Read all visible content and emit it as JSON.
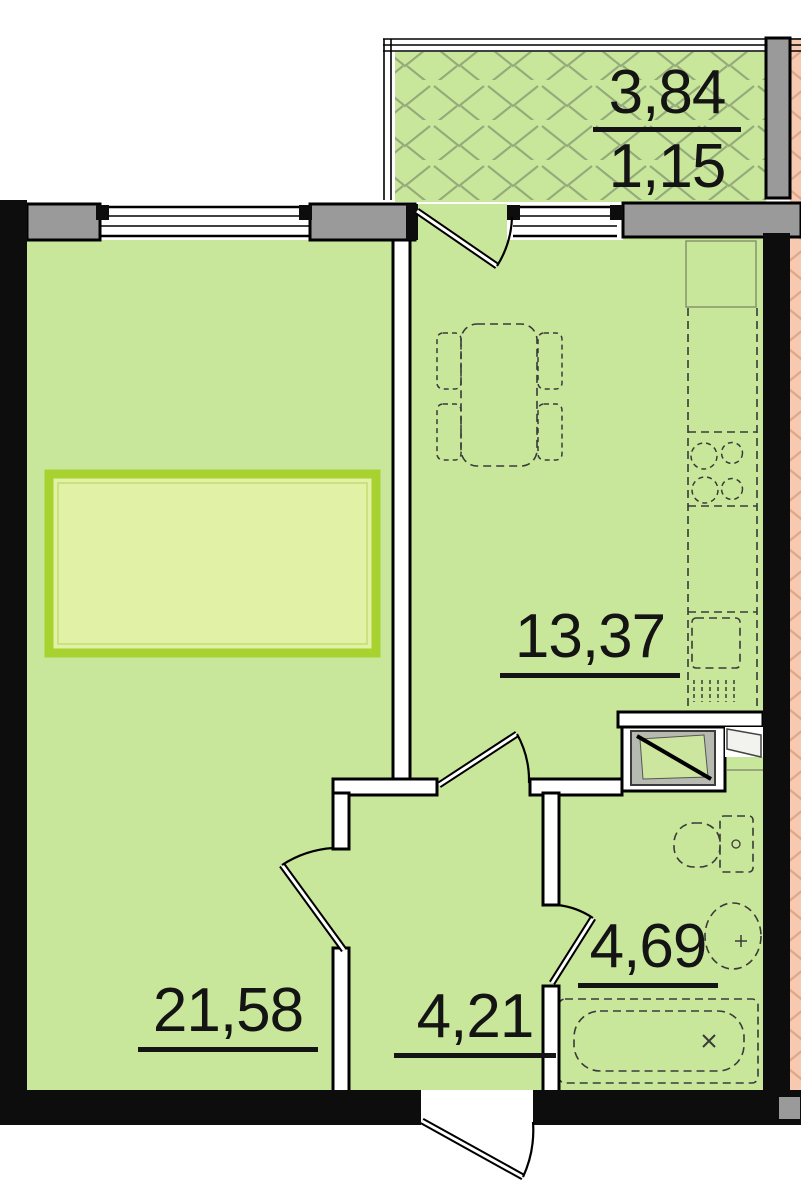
{
  "areas": {
    "balcony_total": "3,84",
    "balcony_reduced": "1,15",
    "kitchen_living": "13,37",
    "room": "21,58",
    "hall": "4,21",
    "bath": "4,69"
  },
  "colors": {
    "room_fill": "#c9e79b",
    "hatch_green": "#96ab7c",
    "neighbor_fill": "#f6c9b0",
    "hatch_pink": "#dfa78a",
    "wall_black": "#0d0d0d",
    "pier_gray": "#9a9a9a",
    "partition_white": "#ffffff",
    "highlight_border": "#a7d22f",
    "highlight_fill": "#e1f1a6",
    "vent_gray": "#b6bab0",
    "label_color": "#141414"
  }
}
